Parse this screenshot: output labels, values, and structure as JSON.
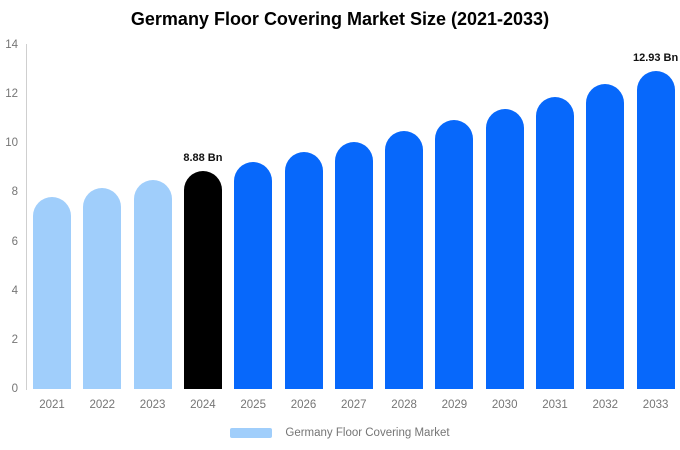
{
  "chart_data": {
    "type": "bar",
    "title": "Germany Floor Covering Market Size (2021-2033)",
    "categories": [
      "2021",
      "2022",
      "2023",
      "2024",
      "2025",
      "2026",
      "2027",
      "2028",
      "2029",
      "2030",
      "2031",
      "2032",
      "2033"
    ],
    "values": [
      7.83,
      8.17,
      8.52,
      8.88,
      9.26,
      9.65,
      10.07,
      10.5,
      10.94,
      11.41,
      11.9,
      12.41,
      12.93
    ],
    "bar_labels": [
      "",
      "",
      "",
      "8.88 Bn",
      "",
      "",
      "",
      "",
      "",
      "",
      "",
      "",
      "12.93 Bn"
    ],
    "bar_colors": [
      "#A0CEFB",
      "#A0CEFB",
      "#A0CEFB",
      "#000000",
      "#0768FB",
      "#0768FB",
      "#0768FB",
      "#0768FB",
      "#0768FB",
      "#0768FB",
      "#0768FB",
      "#0768FB",
      "#0768FB"
    ],
    "ylim": [
      0,
      14
    ],
    "yticks": [
      0,
      2,
      4,
      6,
      8,
      10,
      12,
      14
    ],
    "xlabel": "",
    "ylabel": "",
    "grid": false,
    "legend_position": "bottom",
    "legend": [
      {
        "label": "Germany Floor Covering Market",
        "color": "#A0CEFB"
      }
    ],
    "colors": {
      "historical_bar": "#A0CEFB",
      "current_year_bar": "#000000",
      "forecast_bar": "#0768FB",
      "axis_line": "#CFCFCF",
      "tick_label": "#757575",
      "title": "#000000",
      "value_label": "#111111",
      "background": "#FFFFFF"
    }
  }
}
